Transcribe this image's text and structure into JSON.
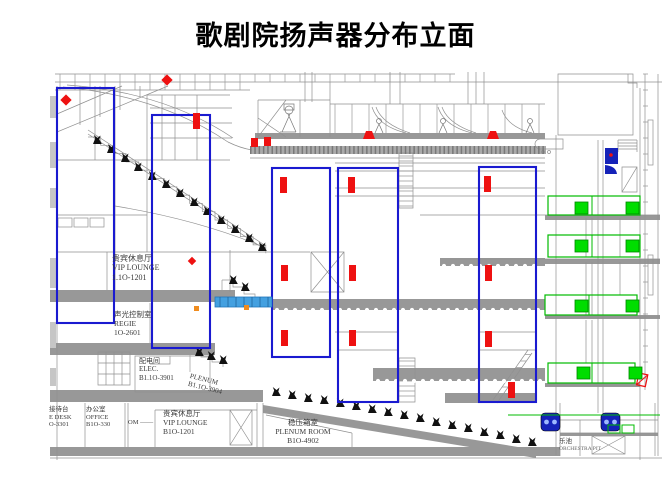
{
  "title": "歌剧院扬声器分布立面",
  "colors": {
    "zone_blue": "#1a1ad0",
    "speaker_red": "#ee1111",
    "effect_green": "#00bb00",
    "effect_green_fill": "#00dd00",
    "bridge_blue": "#44a0e0",
    "cluster_blue": "#1522b8",
    "orange": "#f08c1e",
    "line_gray": "#909090",
    "slab_gray": "#989898"
  },
  "rooms": {
    "vip_upper": {
      "zh": "贵宾休息厅",
      "en": "VIP LOUNGE",
      "code": "1.1O-1201"
    },
    "regie": {
      "zh": "声光控制室",
      "en": "REGIE",
      "code": "1O-2601"
    },
    "elec": {
      "zh": "配电间",
      "en": "ELEC.",
      "code": "B1.1O-3901"
    },
    "plenum_up": {
      "zh": "",
      "en": "PLENUM",
      "code": "B1.1O-3904"
    },
    "reception": {
      "zh": "接待台",
      "en": "E DESK",
      "code": "O-3301"
    },
    "office": {
      "zh": "办公室",
      "en": "OFFICE",
      "code": "B1O-330"
    },
    "vip_b1": {
      "zh": "贵宾休息厅",
      "en": "VIP LOUNGE",
      "code": "B1O-1201"
    },
    "plenum_b1": {
      "zh": "稳压箱室",
      "en": "PLENUM ROOM",
      "code": "B1O-4902"
    },
    "pit": {
      "zh": "乐池",
      "en": "ORCHESTRA PIT",
      "code": ""
    }
  },
  "fragments": {
    "om": "OM ——"
  },
  "drawing": {
    "zones": [
      [
        57,
        88,
        57,
        235
      ],
      [
        152,
        115,
        58,
        233
      ],
      [
        272,
        168,
        58,
        189
      ],
      [
        338,
        168,
        60,
        234
      ],
      [
        479,
        167,
        57,
        235
      ]
    ],
    "speaker_bars": [
      [
        280,
        177
      ],
      [
        348,
        177
      ],
      [
        484,
        176
      ],
      [
        281,
        265
      ],
      [
        349,
        265
      ],
      [
        485,
        265
      ],
      [
        281,
        330
      ],
      [
        349,
        330
      ],
      [
        485,
        331
      ],
      [
        508,
        382
      ],
      [
        193,
        113
      ]
    ],
    "speaker_squares": [
      [
        251,
        138
      ],
      [
        264,
        137
      ]
    ],
    "gallery_speakers": [
      [
        363,
        131
      ],
      [
        487,
        131
      ]
    ],
    "ceiling_diamonds": [
      [
        66,
        100
      ],
      [
        167,
        80
      ]
    ],
    "mini_diamond": [
      192,
      261
    ],
    "orange_markers": [
      [
        194,
        306
      ],
      [
        244,
        305
      ]
    ],
    "right_speaker_symbol": [
      639,
      373
    ],
    "cluster": {
      "x": 605,
      "y": 148
    },
    "pit_monitors": [
      [
        541,
        413
      ],
      [
        601,
        413
      ]
    ],
    "effect_zones": [
      [
        548,
        196,
        92,
        19
      ],
      [
        548,
        235,
        92,
        22
      ],
      [
        545,
        295,
        92,
        20
      ],
      [
        548,
        363,
        87,
        20
      ]
    ],
    "effect_speakers": [
      [
        575,
        202
      ],
      [
        626,
        202
      ],
      [
        575,
        240
      ],
      [
        626,
        240
      ],
      [
        575,
        300
      ],
      [
        626,
        300
      ],
      [
        577,
        367
      ],
      [
        629,
        367
      ]
    ],
    "green_lines": [
      [
        508,
        415,
        660,
        415
      ]
    ],
    "green_boxes": [
      [
        608,
        425,
        12,
        8
      ],
      [
        622,
        425,
        12,
        8
      ]
    ],
    "bridge": [
      215,
      297,
      57,
      10
    ],
    "seats_upper": [
      [
        93,
        144
      ],
      [
        107,
        153
      ],
      [
        121,
        162
      ],
      [
        134,
        171
      ],
      [
        148,
        180
      ],
      [
        162,
        188
      ],
      [
        176,
        197
      ],
      [
        190,
        206
      ],
      [
        203,
        215
      ],
      [
        217,
        224
      ],
      [
        231,
        233
      ],
      [
        245,
        242
      ],
      [
        258,
        251
      ]
    ],
    "seats_stalls": [
      [
        272,
        396
      ],
      [
        288,
        399
      ],
      [
        304,
        402
      ],
      [
        320,
        404
      ],
      [
        336,
        407
      ],
      [
        352,
        410
      ],
      [
        368,
        413
      ],
      [
        384,
        416
      ],
      [
        400,
        419
      ],
      [
        416,
        422
      ],
      [
        432,
        426
      ],
      [
        448,
        429
      ],
      [
        464,
        432
      ],
      [
        480,
        436
      ],
      [
        496,
        439
      ],
      [
        512,
        443
      ],
      [
        528,
        446
      ]
    ],
    "seats_balcony1": [
      [
        229,
        284
      ],
      [
        241,
        291
      ]
    ],
    "seats_box": [
      [
        195,
        356
      ],
      [
        207,
        360
      ],
      [
        219,
        364
      ]
    ],
    "steps": {
      "upper": [
        88,
        137,
        14,
        12.7,
        8.3
      ],
      "balcony1": [
        222,
        280,
        3,
        11,
        7
      ],
      "box": [
        190,
        352,
        3,
        11,
        5
      ]
    }
  }
}
